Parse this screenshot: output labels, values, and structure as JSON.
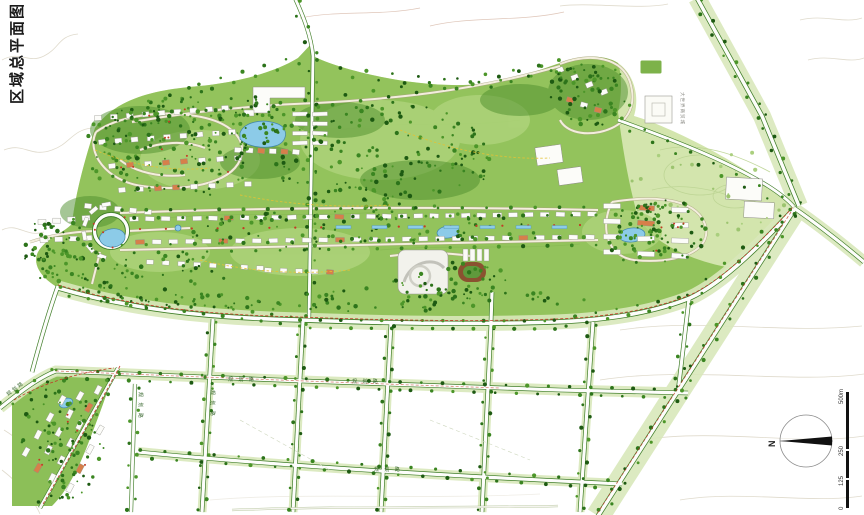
{
  "title": "区域总平面图",
  "compass": {
    "north_label": "N"
  },
  "scale_bar": {
    "labels": [
      "0",
      "125",
      "250",
      "500m"
    ]
  },
  "road_labels": {
    "center_road": "规 划 路",
    "east_center_road": "规 划 路",
    "south_road": "规 划 路",
    "west_vertical_road": "规 划 路",
    "central_vertical_road": "规 划 路",
    "southwest_diagonal_road": "规划路",
    "northeast_district": "大世界商贸城"
  },
  "colors": {
    "site_green": "#93c35c",
    "field_green": "#d3e5ad",
    "tree_dark_green": "#2c731a",
    "road_edge_green": "#3f7d28",
    "water_blue": "#8ccbe8",
    "boundary_red": "#c23a28",
    "path_yellow": "#e3c235",
    "ink_black": "#1a1a1a"
  }
}
